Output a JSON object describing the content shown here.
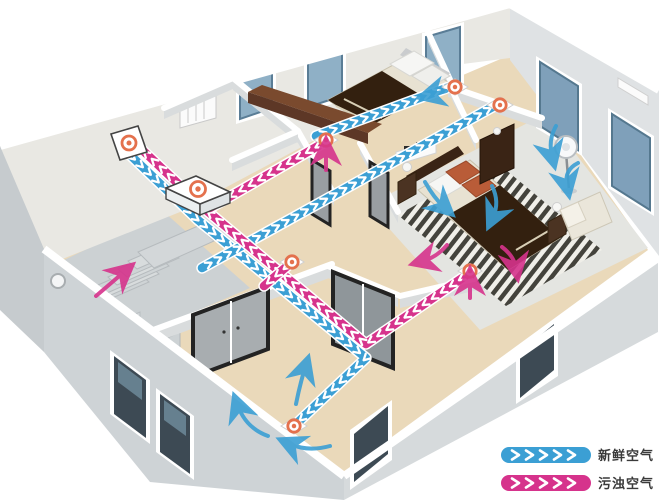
{
  "legend": {
    "items": [
      {
        "id": "fresh",
        "label": "新鲜空气",
        "color": "#3b9fd4"
      },
      {
        "id": "exhaust",
        "label": "污浊空气",
        "color": "#d6338c"
      }
    ]
  },
  "colors": {
    "fresh": "#3b9fd4",
    "exhaust": "#d6338c",
    "vent_ring": "#e4714d",
    "wall_face": "#dcdfe1",
    "floor_wood": "#ead9ba",
    "floor_gray": "#e4e5e1"
  }
}
